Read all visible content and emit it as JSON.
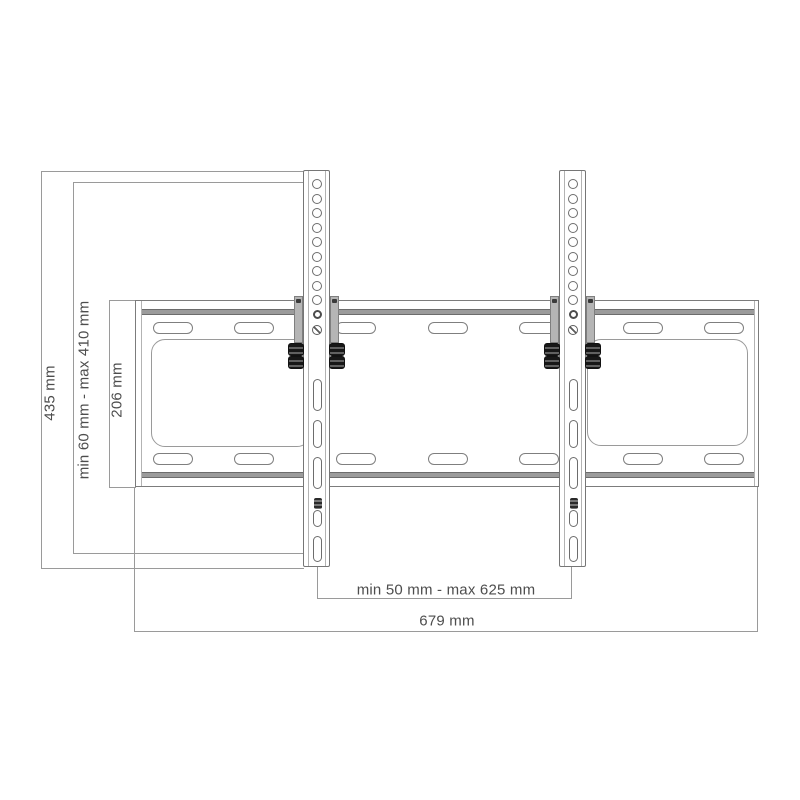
{
  "figure": {
    "kind": "tilting TV wall mount dimensional drawing",
    "labels": {
      "bracket_height": "435 mm",
      "hole_range": "min 60 mm - max 410 mm",
      "plate_height": "206 mm",
      "bracket_span": "min 50 mm - max 625 mm",
      "plate_width": "679 mm"
    },
    "colors": {
      "background": "#ffffff",
      "line": "#8f8f8f",
      "dark_line": "#6c6c6c",
      "flange_band": "#9b9b9b",
      "text": "#4d4d4d",
      "bolt": "#171717",
      "clamp_tab": "#b5b5b5"
    },
    "counts": {
      "bracket_round_holes": 9,
      "bracket_lower_slots": 5,
      "plate_slots_top_row": 7,
      "plate_slots_bottom_row": 7
    }
  }
}
